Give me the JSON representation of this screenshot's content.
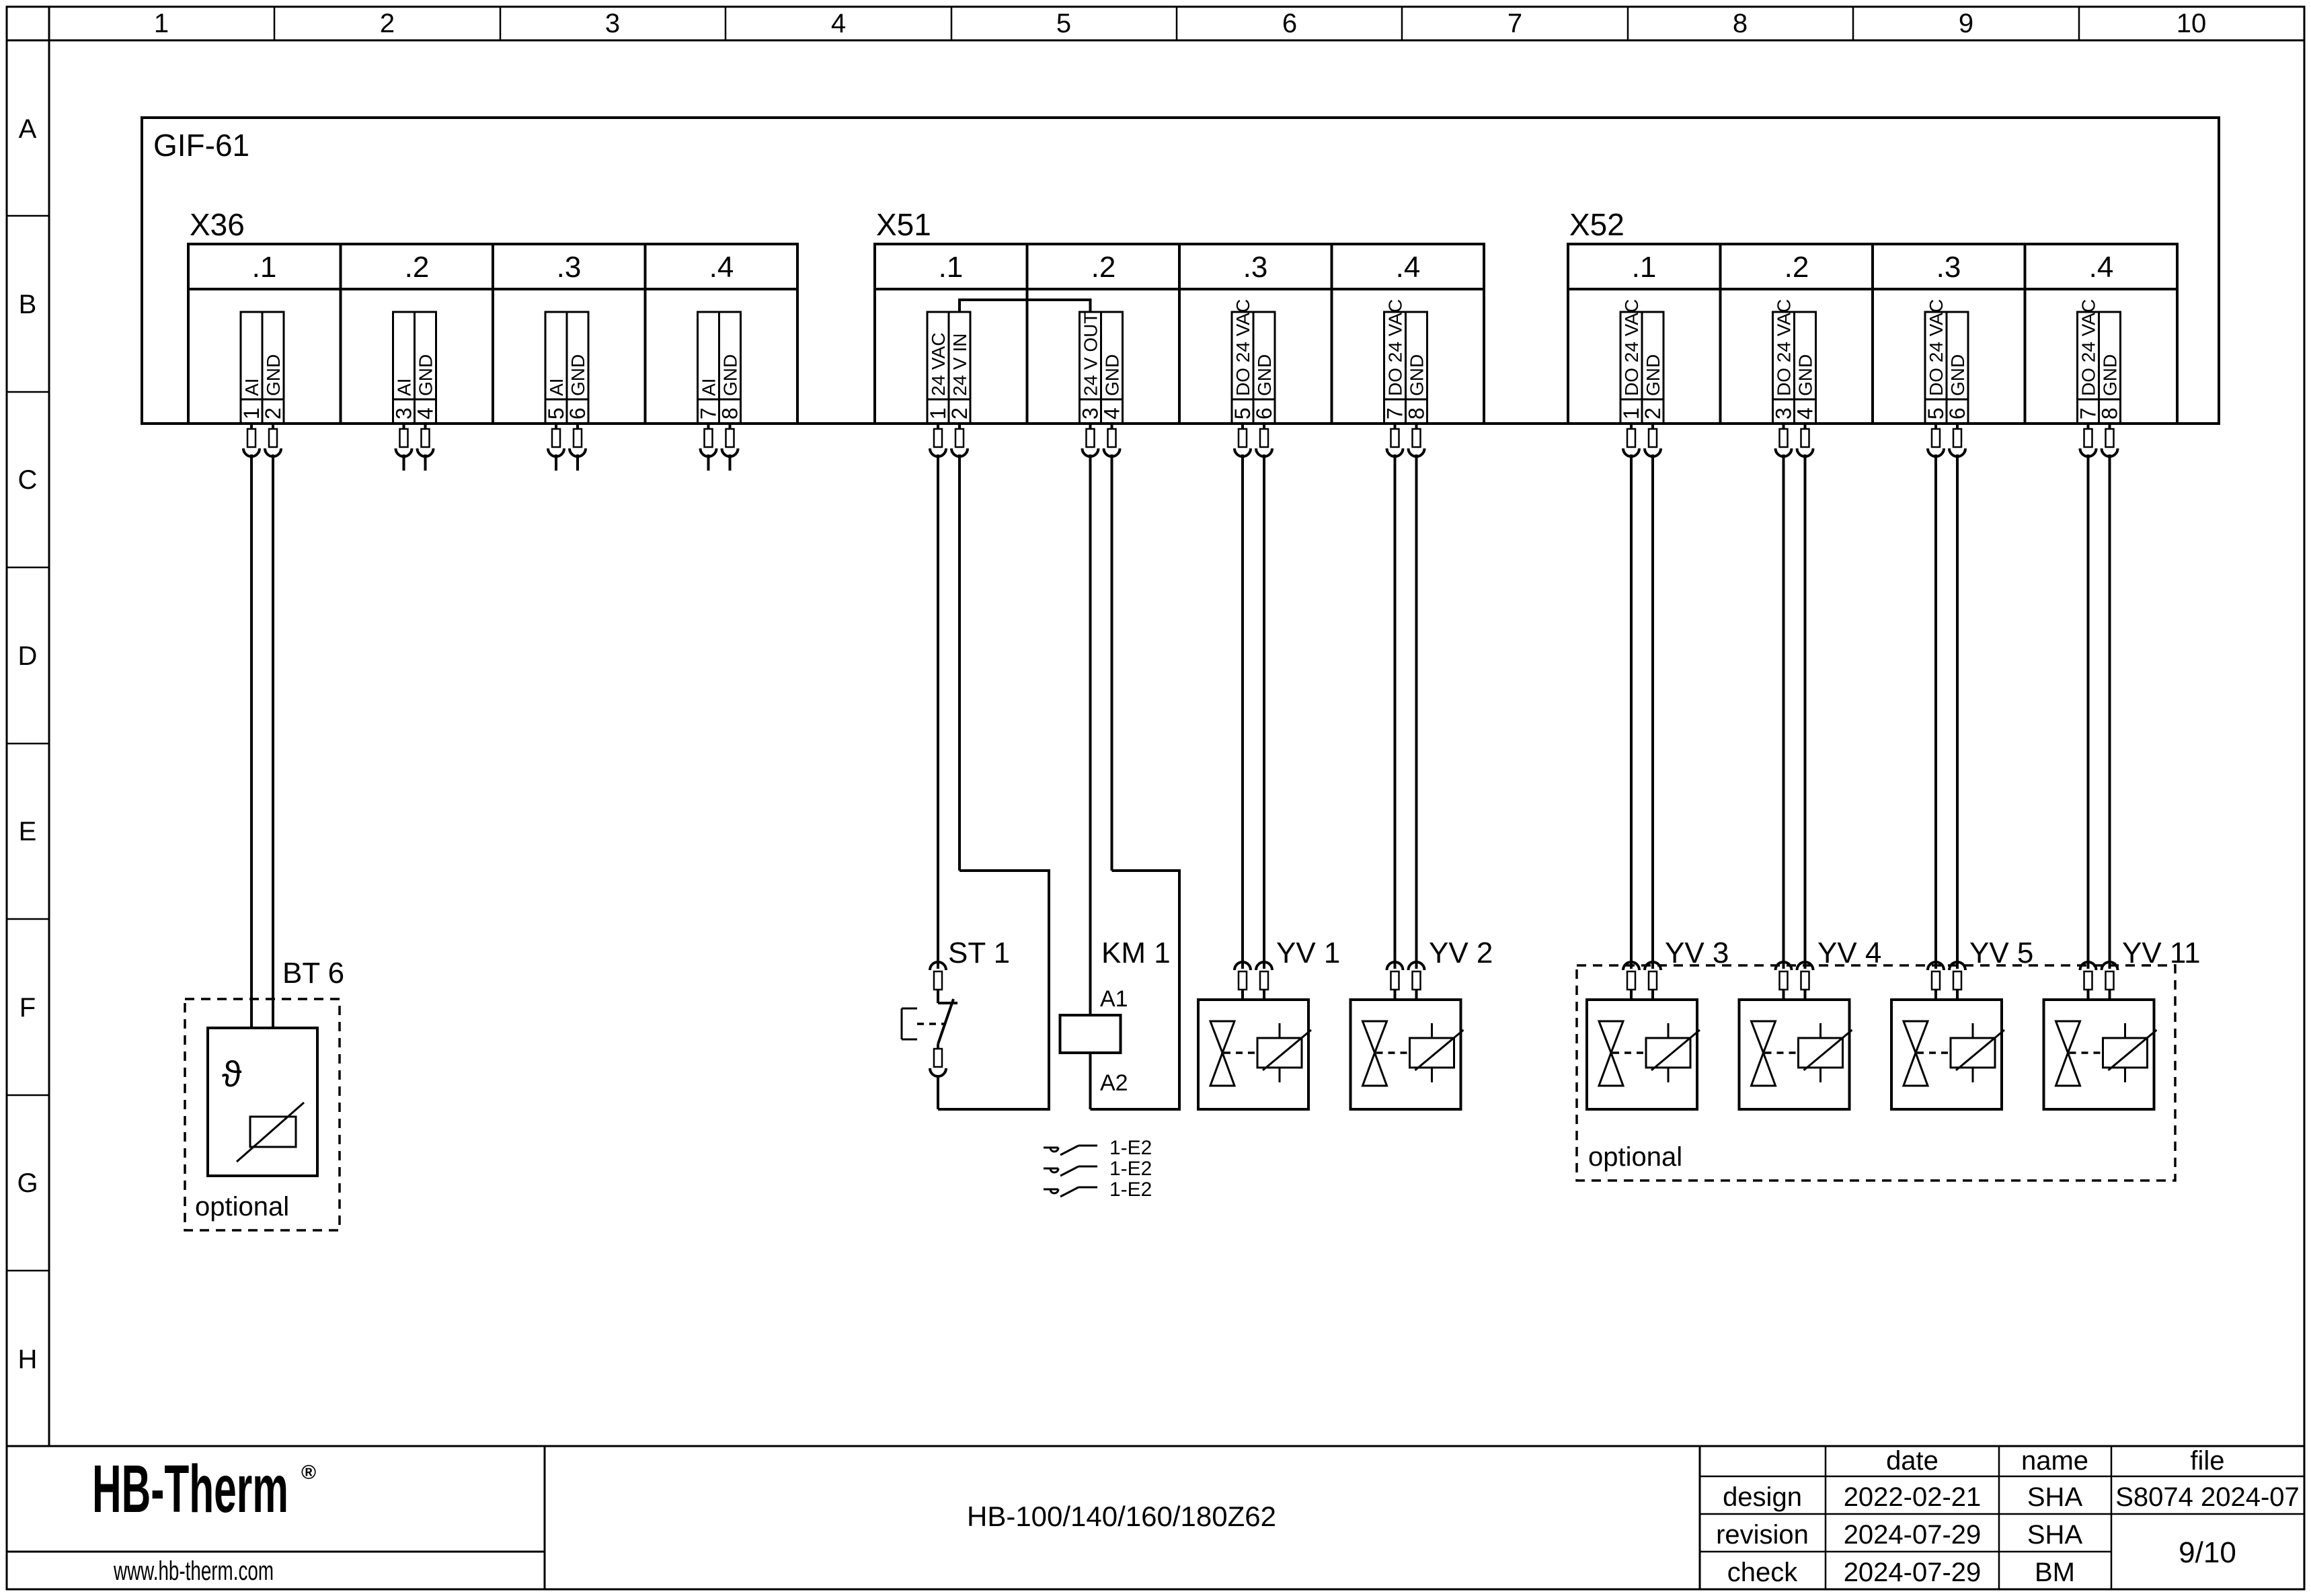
{
  "ruler": {
    "columns": [
      "1",
      "2",
      "3",
      "4",
      "5",
      "6",
      "7",
      "8",
      "9",
      "10"
    ],
    "rows": [
      "A",
      "B",
      "C",
      "D",
      "E",
      "F",
      "G",
      "H"
    ]
  },
  "module": {
    "label": "GIF-61"
  },
  "connectors": {
    "x36": {
      "label": "X36",
      "sections": [
        ".1",
        ".2",
        ".3",
        ".4"
      ],
      "pins": [
        {
          "n": "1",
          "label": "AI"
        },
        {
          "n": "2",
          "label": "GND"
        },
        {
          "n": "3",
          "label": "AI"
        },
        {
          "n": "4",
          "label": "GND"
        },
        {
          "n": "5",
          "label": "AI"
        },
        {
          "n": "6",
          "label": "GND"
        },
        {
          "n": "7",
          "label": "AI"
        },
        {
          "n": "8",
          "label": "GND"
        }
      ]
    },
    "x51": {
      "label": "X51",
      "sections": [
        ".1",
        ".2",
        ".3",
        ".4"
      ],
      "pins": [
        {
          "n": "1",
          "label": "24 VAC"
        },
        {
          "n": "2",
          "label": "24 V IN"
        },
        {
          "n": "3",
          "label": "24 V OUT"
        },
        {
          "n": "4",
          "label": "GND"
        },
        {
          "n": "5",
          "label": "DO 24 VAC"
        },
        {
          "n": "6",
          "label": "GND"
        },
        {
          "n": "7",
          "label": "DO 24 VAC"
        },
        {
          "n": "8",
          "label": "GND"
        }
      ]
    },
    "x52": {
      "label": "X52",
      "sections": [
        ".1",
        ".2",
        ".3",
        ".4"
      ],
      "pins": [
        {
          "n": "1",
          "label": "DO 24 VAC"
        },
        {
          "n": "2",
          "label": "GND"
        },
        {
          "n": "3",
          "label": "DO 24 VAC"
        },
        {
          "n": "4",
          "label": "GND"
        },
        {
          "n": "5",
          "label": "DO 24 VAC"
        },
        {
          "n": "6",
          "label": "GND"
        },
        {
          "n": "7",
          "label": "DO 24 VAC"
        },
        {
          "n": "8",
          "label": "GND"
        }
      ]
    }
  },
  "components": {
    "bt6": {
      "label": "BT 6",
      "theta": "ϑ",
      "optional_label": "optional"
    },
    "st1": {
      "label": "ST 1"
    },
    "km1": {
      "label": "KM 1",
      "a1": "A1",
      "a2": "A2",
      "contact_refs": [
        "1-E2",
        "1-E2",
        "1-E2"
      ]
    },
    "valves": [
      {
        "label": "YV 1"
      },
      {
        "label": "YV 2"
      },
      {
        "label": "YV 3"
      },
      {
        "label": "YV 4"
      },
      {
        "label": "YV 5"
      },
      {
        "label": "YV 11"
      }
    ],
    "optional_label": "optional"
  },
  "titleblock": {
    "logo": {
      "brand": "HB-Therm",
      "reg": "®",
      "website": "www.hb-therm.com",
      "color": "#232949"
    },
    "model": "HB-100/140/160/180Z62",
    "table": {
      "headers": {
        "date": "date",
        "name": "name",
        "file": "file"
      },
      "rows": [
        {
          "label": "design",
          "date": "2022-02-21",
          "name": "SHA"
        },
        {
          "label": "revision",
          "date": "2024-07-29",
          "name": "SHA"
        },
        {
          "label": "check",
          "date": "2024-07-29",
          "name": "BM"
        }
      ],
      "file_value": "S8074 2024-07",
      "page": "9/10"
    }
  }
}
